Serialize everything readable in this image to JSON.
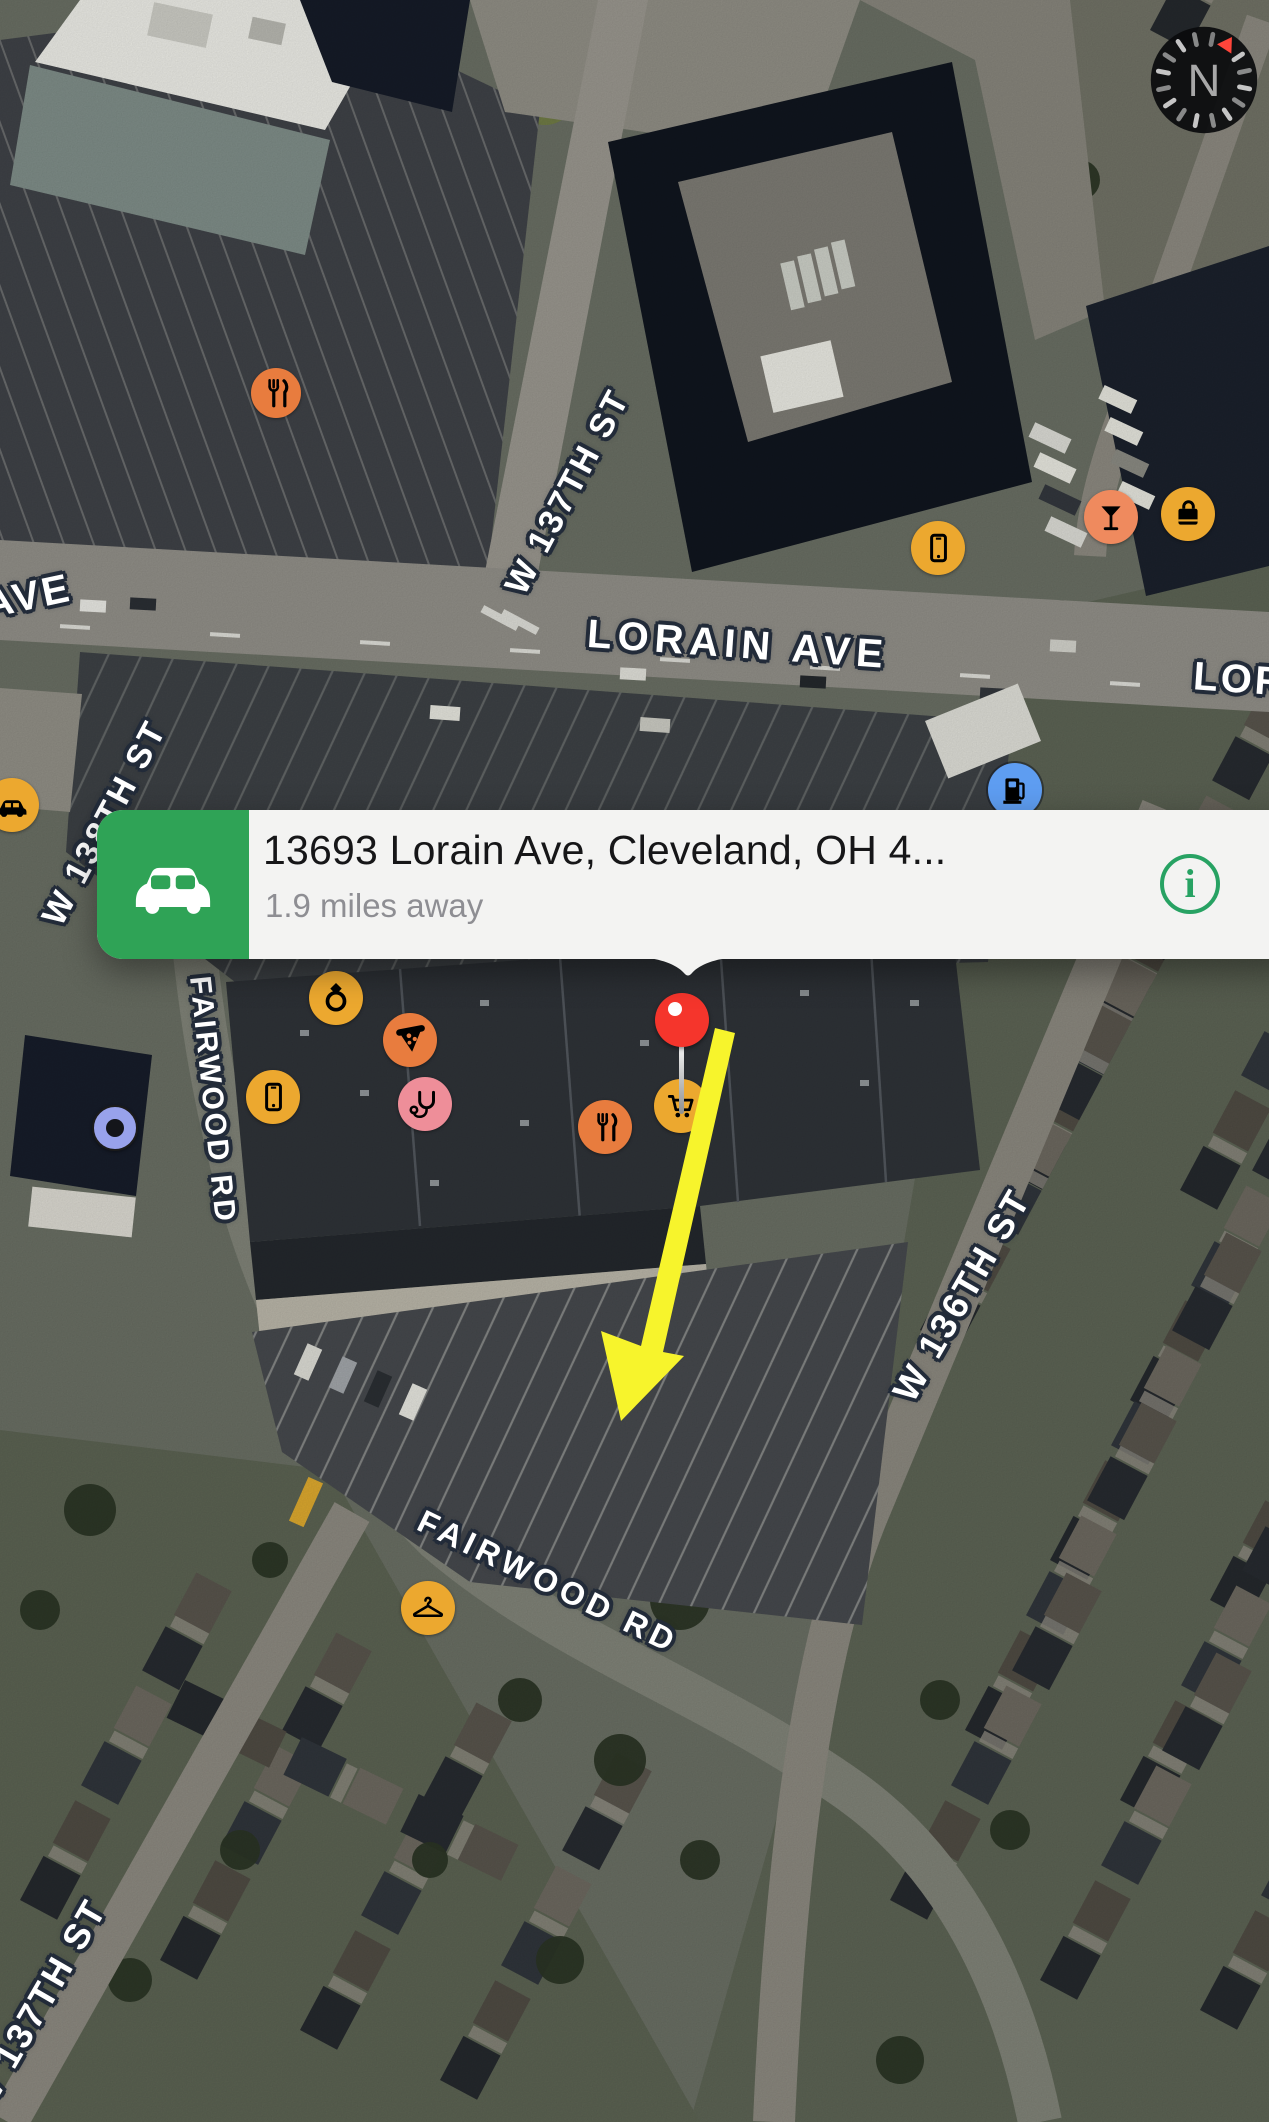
{
  "compass": {
    "north_label": "N"
  },
  "callout": {
    "address": "13693 Lorain Ave, Cleveland, OH 4...",
    "distance": "1.9 miles away",
    "info_glyph": "i",
    "vehicle_icon": "car-icon",
    "accent_green": "#2FA356",
    "info_green": "#27A263"
  },
  "map": {
    "street_labels": [
      {
        "text": "AVE"
      },
      {
        "text": "W 137TH ST"
      },
      {
        "text": "LORAIN AVE"
      },
      {
        "text": "LOR"
      },
      {
        "text": "W 138TH ST"
      },
      {
        "text": "FAIRWOOD RD"
      },
      {
        "text": "W 136TH ST"
      },
      {
        "text": "FAIRWOOD RD"
      },
      {
        "text": "W 137TH ST"
      }
    ],
    "poi_icons": [
      {
        "name": "restaurant-icon",
        "color": "#E87C3E"
      },
      {
        "name": "smartphone-icon",
        "color": "#ECA82F"
      },
      {
        "name": "cocktail-icon",
        "color": "#EF8A5E"
      },
      {
        "name": "shopping-bag-icon",
        "color": "#ECA82F"
      },
      {
        "name": "car-dealer-icon",
        "color": "#ECA82F"
      },
      {
        "name": "fuel-icon",
        "color": "#5E9DF1"
      },
      {
        "name": "jewelry-ring-icon",
        "color": "#ECA82F"
      },
      {
        "name": "pizza-icon",
        "color": "#E87C3E"
      },
      {
        "name": "smartphone-icon",
        "color": "#ECA82F"
      },
      {
        "name": "medical-icon",
        "color": "#EE8E99"
      },
      {
        "name": "restaurant-icon",
        "color": "#E87C3E"
      },
      {
        "name": "shopping-cart-icon",
        "color": "#ECA82F"
      },
      {
        "name": "hanger-icon",
        "color": "#ECA82F"
      },
      {
        "name": "generic-place-dot",
        "color": "#98A2EB"
      }
    ],
    "marker": {
      "type": "dropped-pin",
      "color": "#F5352C"
    },
    "annotation_arrow_color": "#F7F42C",
    "compass_needle_color": "#FF453A"
  }
}
